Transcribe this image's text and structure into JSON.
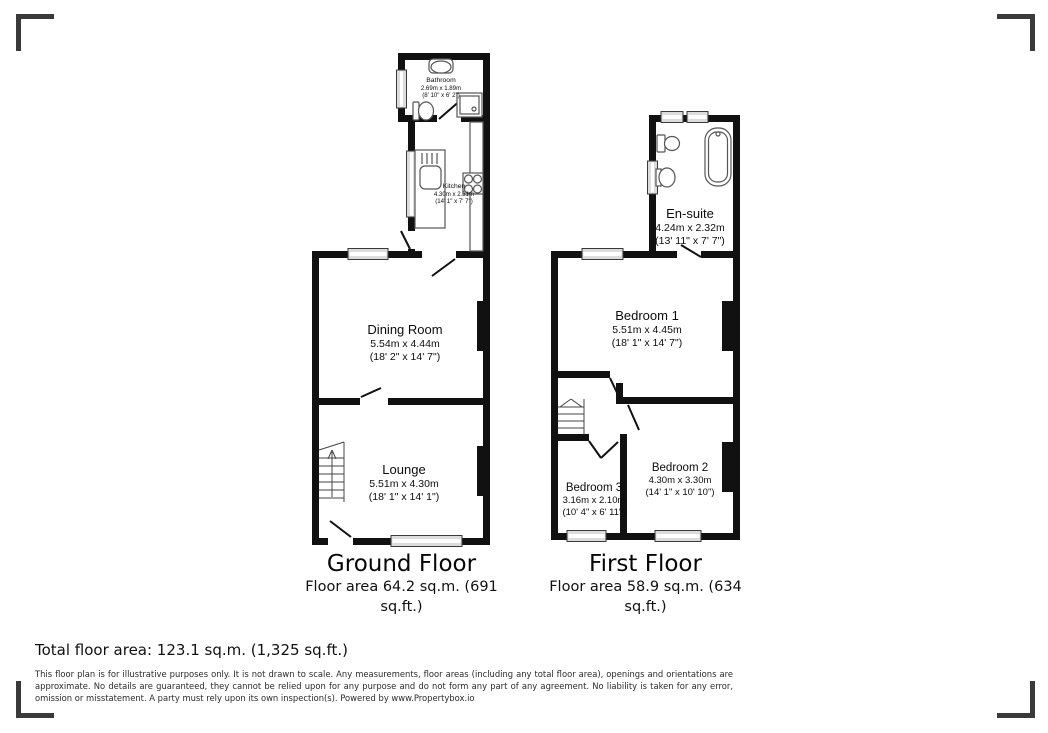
{
  "colors": {
    "wall": "#111111",
    "window_fill": "#dcdcdc",
    "corner_mark": "#3a3a3a",
    "fixture_stroke": "#555555"
  },
  "ground_floor": {
    "title": "Ground Floor",
    "area_line1": "Floor area 64.2 sq.m. (691",
    "area_line2": "sq.ft.)",
    "rooms": {
      "bathroom": {
        "name": "Bathroom",
        "metric": "2.69m x 1.89m",
        "imperial": "(8' 10\" x 6' 2\")"
      },
      "kitchen": {
        "name": "Kitchen",
        "metric": "4.30m x 2.31m",
        "imperial": "(14' 1\" x 7' 7\")"
      },
      "dining_room": {
        "name": "Dining Room",
        "metric": "5.54m x 4.44m",
        "imperial": "(18' 2\" x 14' 7\")"
      },
      "lounge": {
        "name": "Lounge",
        "metric": "5.51m x 4.30m",
        "imperial": "(18' 1\" x 14' 1\")"
      }
    }
  },
  "first_floor": {
    "title": "First Floor",
    "area_line1": "Floor area 58.9 sq.m. (634",
    "area_line2": "sq.ft.)",
    "rooms": {
      "en_suite": {
        "name": "En-suite",
        "metric": "4.24m x 2.32m",
        "imperial": "(13' 11\" x 7' 7\")"
      },
      "bedroom_1": {
        "name": "Bedroom 1",
        "metric": "5.51m x 4.45m",
        "imperial": "(18' 1\" x 14' 7\")"
      },
      "bedroom_2": {
        "name": "Bedroom 2",
        "metric": "4.30m x 3.30m",
        "imperial": "(14' 1\" x 10' 10\")"
      },
      "bedroom_3": {
        "name": "Bedroom 3",
        "metric": "3.16m x 2.10m",
        "imperial": "(10' 4\" x 6' 11\")"
      }
    }
  },
  "summary": {
    "total_area": "Total floor area: 123.1 sq.m. (1,325 sq.ft.)"
  },
  "disclaimer": "This floor plan is for illustrative purposes only. It is not drawn to scale. Any measurements, floor areas (including any total floor area), openings and orientations are approximate. No details are guaranteed, they cannot be relied upon for any purpose and do not form any part of any agreement. No liability is taken for any error, omission or misstatement. A party must rely upon its own inspection(s). Powered by www.Propertybox.io"
}
